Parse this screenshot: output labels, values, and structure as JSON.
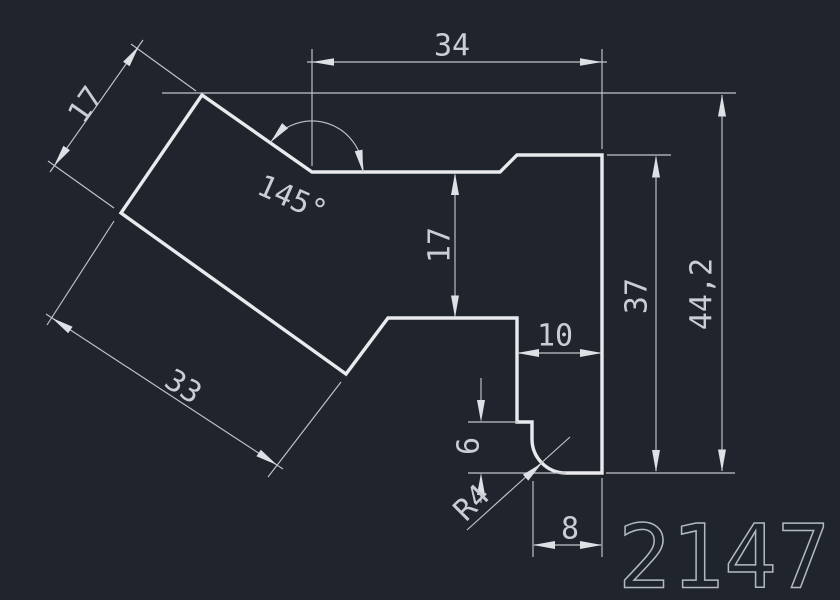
{
  "canvas": {
    "background_color": "#20252d",
    "outline_color": "#e8eaed",
    "dim_line_color": "#bfc4ca",
    "dim_text_color": "#c9ced4",
    "drawing_number_color": "#b3b9c0"
  },
  "drawing_number": "2147",
  "dims": {
    "top_width": "34",
    "arm_width": "17",
    "vertex_angle": "145°",
    "notch_depth": "17",
    "right_height": "37",
    "overall_height": "44,2",
    "arm_length": "33",
    "step_width": "10",
    "step_height": "6",
    "fillet_radius": "R4",
    "bottom_width": "8"
  }
}
